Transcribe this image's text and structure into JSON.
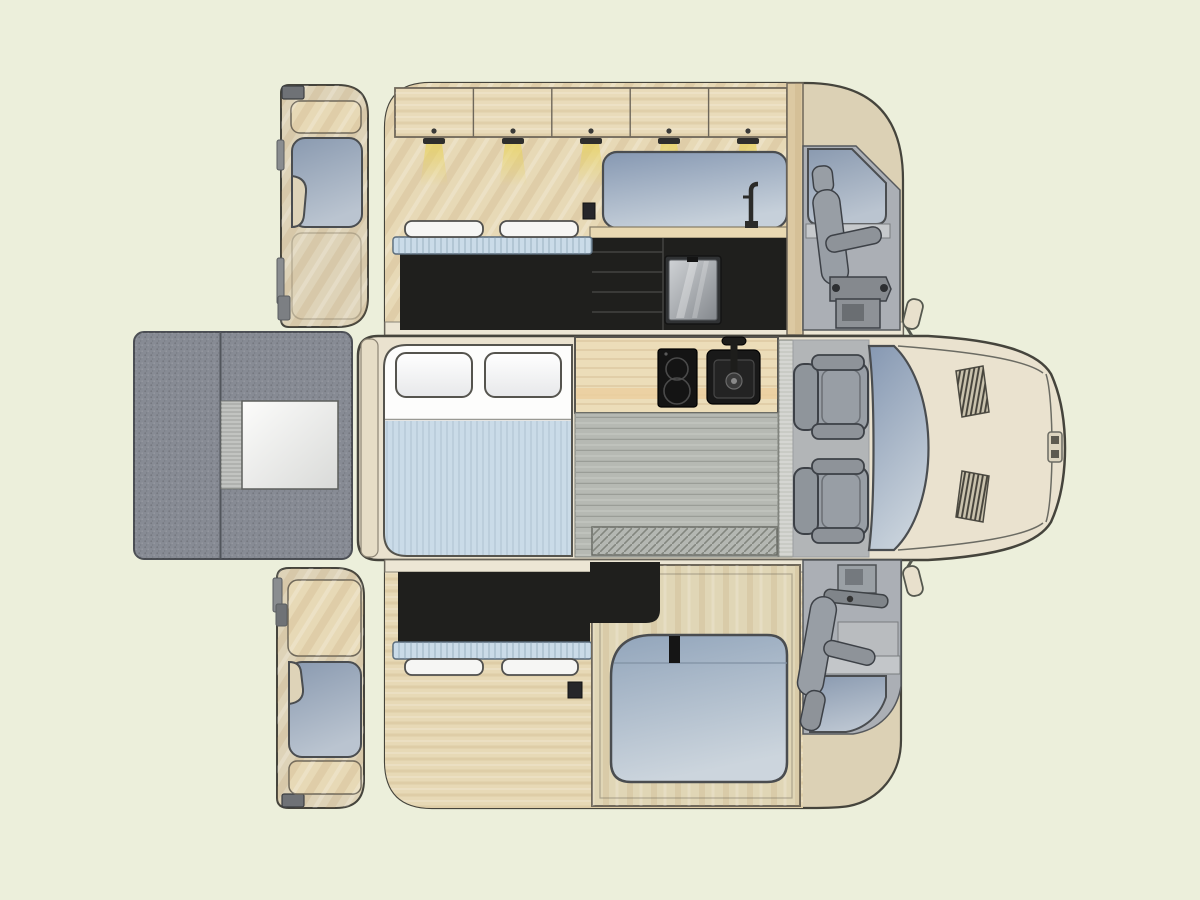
{
  "diagram": {
    "type": "campervan-conversion-floorplan",
    "views": {
      "galley_elevation": "galley wall elevation with overhead cabinets, kitchen and cab seat",
      "floor_plan": "top-down floor plan with bed, galley, floor and cab",
      "bed_side_elevation": "sliding-door wall elevation with bed base and wardrobe window",
      "rear_door_top": "rear door interior panel (upper)",
      "rear_door_bottom": "rear door interior panel (lower)",
      "rear_view_panel": "rear carpeted panel with white hatch"
    },
    "components": {
      "overhead_cabinet_doors": 5,
      "puck_lights": 5,
      "galley_drawers": 4,
      "cab_seats": 2,
      "bed_pillows": 2,
      "hood_vents": 2,
      "windows": 7,
      "cooktop_burners": 2,
      "sinks": 1,
      "fridges": 1
    }
  },
  "colors": {
    "bg": "#ecefdb",
    "line": "#45443c",
    "cream": "#eae2cf",
    "tan": "#dcd1b5",
    "wood": "#e7d9b6",
    "woodCab": "#e9dbba",
    "woodStrip": "#dcc9a2",
    "doorBeige": "#ded3b8",
    "counter": "#ecddb9",
    "counterAccent": "#eccf9f",
    "black": "#1f1f1d",
    "mattress": "#cadbe8",
    "pillow": "#f6f6f4",
    "floorGray": "#b6b9b3",
    "floorStrip": "#ece6d4",
    "mat": "#b4b7b2",
    "carpet": "#878b94",
    "whitePanelL": "#fcfcfb",
    "whitePanelD": "#d9dad8",
    "seat": "#989ea5",
    "seatAlt": "#8e9399",
    "seatLine": "#3d4147",
    "cabPanel": "#abafb5",
    "cabFloor": "#b2b5b7",
    "threshold": "#c9cbc5",
    "outlet": "#26262a",
    "cone": "#e8d35f",
    "winDark": "#8698b2",
    "winLight": "#c6d0da",
    "slideDark": "#92a5bb",
    "slideLight": "#ccd5dd",
    "doorWinDark": "#8a9ab0",
    "doorWinLight": "#bac4d0",
    "fridgeLight": "#cfd2d5",
    "fridgeDark": "#84888d"
  }
}
